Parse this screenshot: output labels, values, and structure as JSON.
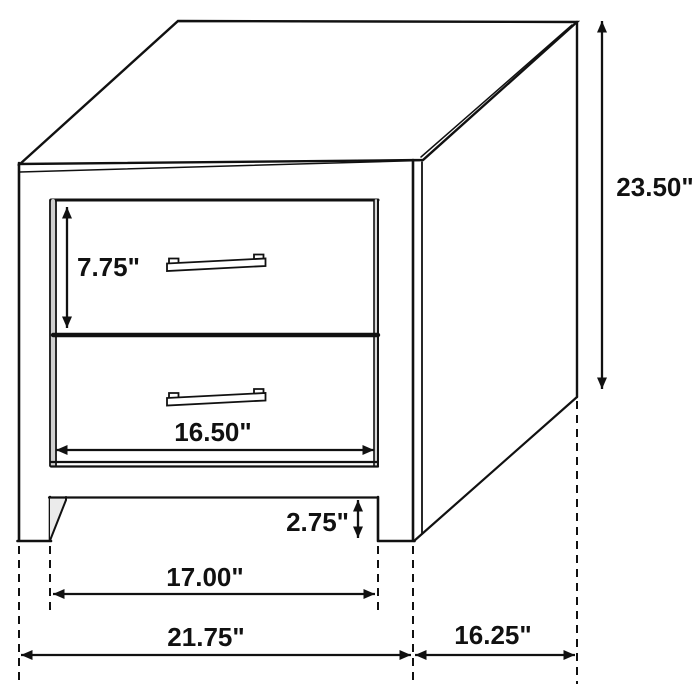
{
  "diagram": {
    "subject": "2-drawer nightstand dimension drawing",
    "background_color": "#ffffff",
    "line_color": "#111111",
    "dimensions": {
      "drawer_height": "7.75\"",
      "overall_height": "23.50\"",
      "drawer_opening_width": "16.50\"",
      "base_clearance": "2.75\"",
      "leg_inner_span": "17.00\"",
      "overall_width": "21.75\"",
      "side_depth": "16.25\""
    }
  }
}
